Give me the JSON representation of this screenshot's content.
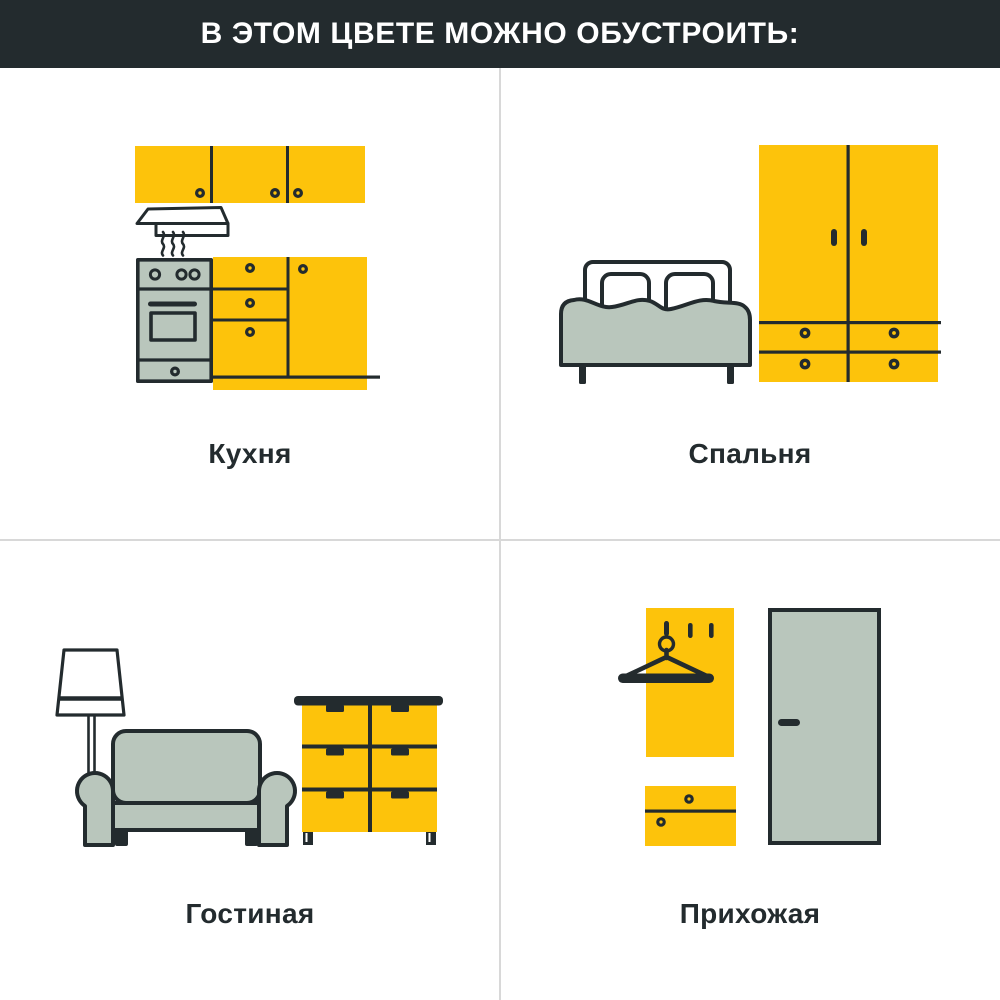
{
  "header": {
    "title": "В ЭТОМ ЦВЕТЕ МОЖНО ОБУСТРОИТЬ:"
  },
  "colors": {
    "yellow": "#FDC30B",
    "gray": "#B9C6BC",
    "dark": "#232B2E",
    "headerbg": "#232B2E",
    "divider": "#D8D8D8",
    "canvas": "#FFFFFF"
  },
  "sections": {
    "kitchen": {
      "label": "Кухня",
      "icons": [
        "wall-cabinets-icon",
        "range-hood-icon",
        "stove-icon",
        "base-cabinets-icon"
      ]
    },
    "bedroom": {
      "label": "Спальня",
      "icons": [
        "bed-icon",
        "wardrobe-icon"
      ]
    },
    "living": {
      "label": "Гостиная",
      "icons": [
        "floor-lamp-icon",
        "sofa-icon",
        "chest-of-drawers-icon"
      ]
    },
    "hallway": {
      "label": "Прихожая",
      "icons": [
        "coat-rack-panel-icon",
        "hanger-icon",
        "shoe-cabinet-icon",
        "door-icon"
      ]
    }
  }
}
